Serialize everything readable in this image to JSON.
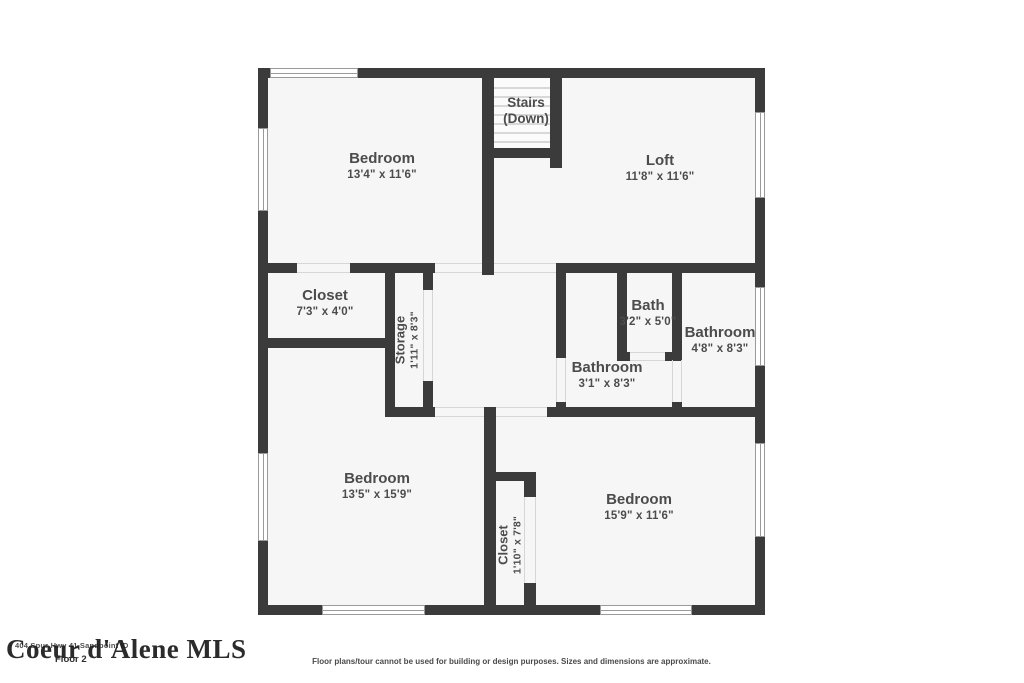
{
  "floor_label": "Floor 2",
  "watermark": {
    "text": "Coeur d'Alene MLS",
    "address_line": "404 Spur Hwy 41 Sandpoint ID"
  },
  "disclaimer": "Floor plans/tour cannot be used for building or design purposes. Sizes and dimensions are approximate.",
  "stairs": {
    "line1": "Stairs",
    "line2": "(Down)"
  },
  "rooms": [
    {
      "name": "Bedroom",
      "dims": "13'4\" x 11'6\""
    },
    {
      "name": "Loft",
      "dims": "11'8\" x 11'6\""
    },
    {
      "name": "Closet",
      "dims": "7'3\" x 4'0\""
    },
    {
      "name": "Storage",
      "dims": "1'11\" x 8'3\""
    },
    {
      "name": "Bath",
      "dims": "3'2\" x 5'0\""
    },
    {
      "name": "Bathroom",
      "dims": "4'8\" x 8'3\""
    },
    {
      "name": "Bathroom",
      "dims": "3'1\" x 8'3\""
    },
    {
      "name": "Bedroom",
      "dims": "13'5\" x 15'9\""
    },
    {
      "name": "Closet",
      "dims": "1'10\" x 7'8\""
    },
    {
      "name": "Bedroom",
      "dims": "15'9\" x 11'6\""
    }
  ],
  "colors": {
    "wall": "#3b3b3b",
    "floor_fill": "#f6f6f6",
    "label": "#4c4c4c"
  }
}
